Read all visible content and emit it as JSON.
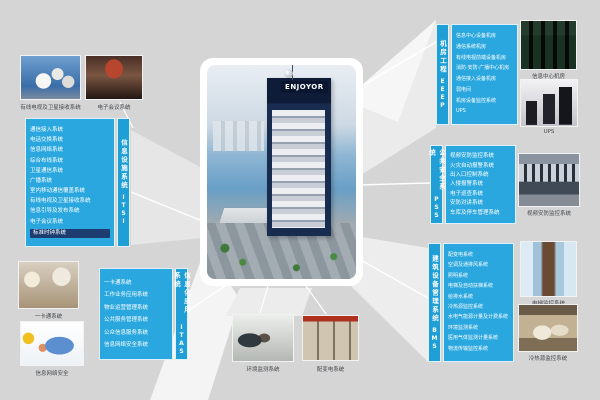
{
  "building": {
    "sign": "ENJOYOR"
  },
  "colors": {
    "background": "#d5d5d5",
    "box_blue": "#29a7de",
    "strip_blue": "#1f9fd6",
    "highlight_navy": "#1d3d71"
  },
  "boxes": {
    "itsi": {
      "title": "信息设施系统",
      "code": "ITSI",
      "items": [
        "通信接入系统",
        "电话交换系统",
        "信息网络系统",
        "综合布线系统",
        "卫星通信系统",
        "广播系统",
        "室内移动通信覆盖系统",
        "有线电视及卫星接收系统",
        "信息引导及发布系统",
        "电子会议系统",
        "标准时钟系统"
      ]
    },
    "eeep": {
      "title": "机房工程",
      "code": "EEEP",
      "items": [
        "信息中心设备机房",
        "通信系统机房",
        "有线电视前端设备机房",
        "消防·安防·广播中心机房",
        "通信接入设备机房",
        "弱电间",
        "机房设备监控系统",
        "UPS"
      ]
    },
    "pss": {
      "title": "公共安全系统",
      "code": "PSS",
      "items": [
        "视频安防监控系统",
        "火灾自动报警系统",
        "出入口控制系统",
        "入侵报警系统",
        "电子巡查系统",
        "安防对讲系统",
        "车库及停车管理系统"
      ]
    },
    "bms": {
      "title": "建筑设备管理系统",
      "code": "BMS",
      "items": [
        "配变电系统",
        "空调及通排风系统",
        "照明系统",
        "电梯及自动扶梯系统",
        "给排水系统",
        "冷热源监控系统",
        "水电气能源计量及计费系统",
        "环境监测系统",
        "医用气体监测计量系统",
        "物流传输监控系统"
      ]
    },
    "itas": {
      "title": "信息化应用系统",
      "code": "ITAS",
      "items": [
        "一卡通系统",
        "工作业务应用系统",
        "物业运营管理系统",
        "公共服务管理系统",
        "公众信息服务系统",
        "信息网络安全系统"
      ]
    }
  },
  "photos": [
    {
      "id": "satellite-dishes",
      "caption": "有线电视及卫星接收系统"
    },
    {
      "id": "conference-hall",
      "caption": "电子会议系统"
    },
    {
      "id": "card-counter",
      "caption": "一卡通系统"
    },
    {
      "id": "network-security",
      "caption": "信息网络安全"
    },
    {
      "id": "monitoring-lab",
      "caption": "环境监测系统"
    },
    {
      "id": "power-cabinets",
      "caption": "配变电系统"
    },
    {
      "id": "server-room",
      "caption": "信息中心机房"
    },
    {
      "id": "ups-units",
      "caption": "UPS"
    },
    {
      "id": "control-room",
      "caption": "视频安防监控系统"
    },
    {
      "id": "elevator-atrium",
      "caption": "电梯监控系统"
    },
    {
      "id": "hvac-office",
      "caption": "冷热源监控系统"
    }
  ]
}
